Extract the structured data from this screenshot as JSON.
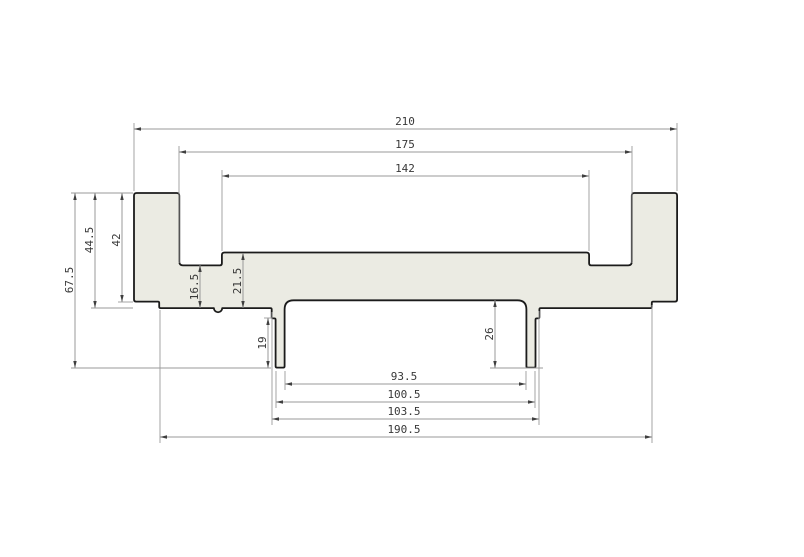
{
  "drawing": {
    "canvas": {
      "width": 804,
      "height": 557,
      "background": "#ffffff"
    },
    "style": {
      "profile_fill": "#ebebe3",
      "profile_stroke": "#1b1b1b",
      "profile_stroke_width": 1.8,
      "dim_line_color": "#9a9a9a",
      "dim_line_width": 1,
      "arrow_color": "#3f3f3f",
      "text_color": "#383838",
      "font_size": 11
    },
    "profile": {
      "description": "aluminium extrusion cross-section",
      "units_scale_px_per_mm": 2.586,
      "origin_px": {
        "x": 134,
        "y": 193
      },
      "outline_mm": [
        {
          "x": 0,
          "y": 0,
          "r": 1
        },
        {
          "x": 17.5,
          "y": 0,
          "r": 1
        },
        {
          "x": 17.5,
          "y": 28,
          "r": 1.4
        },
        {
          "x": 34,
          "y": 28,
          "r": 0.8
        },
        {
          "x": 34,
          "y": 23,
          "r": 1
        },
        {
          "x": 176,
          "y": 23,
          "r": 1
        },
        {
          "x": 176,
          "y": 28,
          "r": 0.8
        },
        {
          "x": 192.5,
          "y": 28,
          "r": 1.4
        },
        {
          "x": 192.5,
          "y": 0,
          "r": 1
        },
        {
          "x": 210,
          "y": 0,
          "r": 1
        },
        {
          "x": 210,
          "y": 42,
          "r": 0.8
        },
        {
          "x": 200.25,
          "y": 42,
          "r": 0.5
        },
        {
          "x": 200.25,
          "y": 44.5,
          "r": 0.5
        },
        {
          "x": 156.75,
          "y": 44.5,
          "r": 0.5
        },
        {
          "x": 156.75,
          "y": 48.5,
          "r": 0.5
        },
        {
          "x": 155.25,
          "y": 48.5,
          "r": 0.5
        },
        {
          "x": 155.25,
          "y": 67.5,
          "r": 0.5
        },
        {
          "x": 151.75,
          "y": 67.5,
          "r": 0.5
        },
        {
          "x": 151.75,
          "y": 41.5,
          "r": 3.5
        },
        {
          "x": 58.25,
          "y": 41.5,
          "r": 3.5
        },
        {
          "x": 58.25,
          "y": 67.5,
          "r": 0.5
        },
        {
          "x": 54.75,
          "y": 67.5,
          "r": 0.5
        },
        {
          "x": 54.75,
          "y": 48.5,
          "r": 0.5
        },
        {
          "x": 53.25,
          "y": 48.5,
          "r": 0.5
        },
        {
          "x": 53.25,
          "y": 44.5,
          "r": 0.5
        },
        {
          "x": 34.1,
          "y": 44.5,
          "r": 0
        },
        {
          "x": 30.9,
          "y": 44.5,
          "arc": 1.6
        },
        {
          "x": 9.75,
          "y": 44.5,
          "r": 0.5
        },
        {
          "x": 9.75,
          "y": 42,
          "r": 0.5
        },
        {
          "x": 0,
          "y": 42,
          "r": 0.8
        }
      ]
    },
    "dimensions": [
      {
        "label": "210",
        "value": 210,
        "orient": "h",
        "x1": 134,
        "y1": 129,
        "x2": 677,
        "y2": 129,
        "tx": 405,
        "ty": 125,
        "ext": [
          [
            134,
            191,
            134,
            123
          ],
          [
            677,
            191,
            677,
            123
          ]
        ]
      },
      {
        "label": "175",
        "value": 175,
        "orient": "h",
        "x1": 179,
        "y1": 152,
        "x2": 632,
        "y2": 152,
        "tx": 405,
        "ty": 148,
        "ext": [
          [
            179,
            263,
            179,
            146
          ],
          [
            632,
            263,
            632,
            146
          ]
        ]
      },
      {
        "label": "142",
        "value": 142,
        "orient": "h",
        "x1": 222,
        "y1": 176,
        "x2": 589,
        "y2": 176,
        "tx": 405,
        "ty": 172,
        "ext": [
          [
            222,
            251,
            222,
            170
          ],
          [
            589,
            251,
            589,
            170
          ]
        ]
      },
      {
        "label": "93.5",
        "value": 93.5,
        "orient": "h",
        "x1": 285,
        "y1": 384,
        "x2": 526,
        "y2": 384,
        "tx": 404,
        "ty": 380,
        "ext": [
          [
            285,
            371,
            285,
            390
          ],
          [
            526,
            371,
            526,
            390
          ]
        ]
      },
      {
        "label": "100.5",
        "value": 100.5,
        "orient": "h",
        "x1": 276,
        "y1": 402,
        "x2": 535,
        "y2": 402,
        "tx": 404,
        "ty": 398,
        "ext": [
          [
            276,
            371,
            276,
            408
          ],
          [
            535,
            371,
            535,
            408
          ]
        ]
      },
      {
        "label": "103.5",
        "value": 103.5,
        "orient": "h",
        "x1": 272,
        "y1": 419,
        "x2": 539,
        "y2": 419,
        "tx": 404,
        "ty": 415,
        "ext": [
          [
            272,
            312,
            272,
            425
          ],
          [
            539,
            311,
            539,
            425
          ]
        ]
      },
      {
        "label": "190.5",
        "value": 190.5,
        "orient": "h",
        "x1": 160,
        "y1": 437,
        "x2": 652,
        "y2": 437,
        "tx": 404,
        "ty": 433,
        "ext": [
          [
            160,
            310,
            160,
            443
          ],
          [
            652,
            305,
            652,
            443
          ]
        ]
      },
      {
        "label": "67.5",
        "value": 67.5,
        "orient": "v",
        "x1": 75,
        "y1": 193,
        "x2": 75,
        "y2": 368,
        "tx": 73,
        "ty": 280,
        "ext": [
          [
            71,
            193,
            133,
            193
          ],
          [
            71,
            368,
            271,
            368
          ]
        ]
      },
      {
        "label": "44.5",
        "value": 44.5,
        "orient": "v",
        "x1": 95,
        "y1": 193,
        "x2": 95,
        "y2": 308,
        "tx": 93,
        "ty": 240,
        "ext": [
          [
            91,
            308,
            133,
            308
          ]
        ]
      },
      {
        "label": "42",
        "value": 42,
        "orient": "v",
        "x1": 122,
        "y1": 193,
        "x2": 122,
        "y2": 302,
        "tx": 120,
        "ty": 240,
        "ext": [
          [
            118,
            302,
            133,
            302
          ]
        ]
      },
      {
        "label": "16.5",
        "value": 16.5,
        "orient": "v",
        "x1": 200,
        "y1": 265,
        "x2": 200,
        "y2": 308,
        "tx": 198,
        "ty": 287,
        "ext": []
      },
      {
        "label": "21.5",
        "value": 21.5,
        "orient": "v",
        "x1": 243,
        "y1": 253,
        "x2": 243,
        "y2": 308,
        "tx": 241,
        "ty": 281,
        "ext": []
      },
      {
        "label": "19",
        "value": 19,
        "orient": "v",
        "x1": 268,
        "y1": 318,
        "x2": 268,
        "y2": 368,
        "tx": 266,
        "ty": 343,
        "ext": [
          [
            264,
            318,
            272,
            318
          ]
        ]
      },
      {
        "label": "26",
        "value": 26,
        "orient": "v",
        "x1": 495,
        "y1": 300,
        "x2": 495,
        "y2": 368,
        "tx": 493,
        "ty": 334,
        "ext": [
          [
            490,
            368,
            543,
            368
          ]
        ]
      }
    ]
  }
}
